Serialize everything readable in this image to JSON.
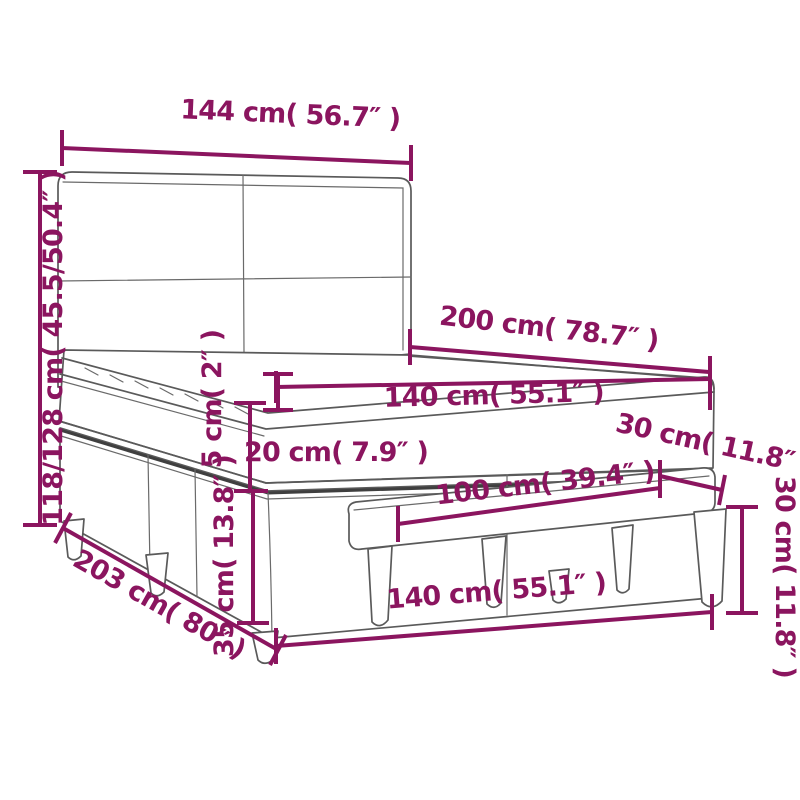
{
  "diagram": {
    "kind": "furniture-dimension-diagram",
    "subject": "box spring bed with headboard, mattress topper and bench",
    "accent_color": "#8B155F",
    "line_color": "#5A5A5A",
    "background_color": "#FFFFFF",
    "dimensions": {
      "headboard_width": "144 cm( 56.7″ )",
      "total_height": "118/128 cm( 45.5/50.4″ )",
      "bed_length": "200 cm( 78.7″ )",
      "mattress_width": "140 cm( 55.1″ )",
      "topper_thickness": "5 cm( 2″ )",
      "mattress_thickness": "20 cm( 7.9″ )",
      "base_height": "35 cm( 13.8″ )",
      "total_depth": "203 cm( 80″ )",
      "bed_width": "140 cm( 55.1″ )",
      "bench_length": "100 cm( 39.4″ )",
      "bench_depth": "30 cm( 11.8″ )",
      "bench_height": "30 cm( 11.8″ )"
    }
  }
}
